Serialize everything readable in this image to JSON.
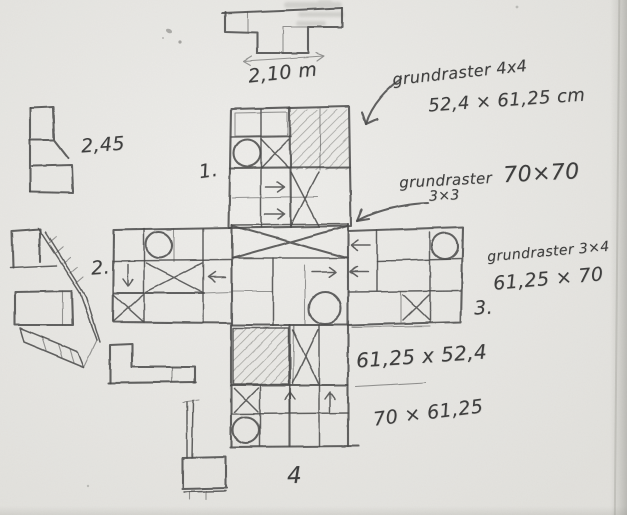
{
  "colors": {
    "paper": "#e9e8e4",
    "pencil": "#474747",
    "pencil-light": "#6b6b67",
    "ink-text": "#3e3e3e"
  },
  "annotations": {
    "top_dimension": "2,10 m",
    "left_dimension": "2,45",
    "grid_4x4": {
      "title": "grundraster 4x4",
      "size": "52,4 × 61,25 cm"
    },
    "grid_3x3": {
      "title": "grundraster",
      "dims": "70×70",
      "sub": "3×3"
    },
    "grid_3x4": {
      "title": "grundraster 3×4",
      "size": "61,25 × 70"
    },
    "center_dimension": "61,25 x 52,4",
    "bottom_dimension": "70 × 61,25",
    "module_labels": {
      "m1": "1.",
      "m2": "2.",
      "m3": "3.",
      "m4": "4"
    }
  }
}
